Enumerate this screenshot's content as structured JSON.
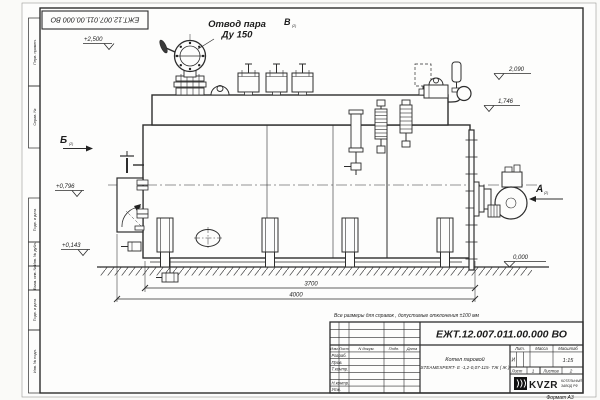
{
  "title_block": {
    "doc_number": "ЕЖТ.12.007.011.00.000  ВО",
    "doc_number_top": "ЕЖТ.12.007.011.00.000  ВО",
    "note": "Все размеры для справок , допустимые отклонения  ±100  мм",
    "product_line1": "Котел паровой",
    "product_line2": "STEAMEXPERT- Е -1,2-0,07-115- ТЖ ( Ж )",
    "lit_header": "Лит.",
    "mass_header": "Масса",
    "scale_header": "Масштаб",
    "lit_value": "И",
    "scale_value": "1:15",
    "sheet_label": "Лист",
    "sheet_value": "1",
    "sheets_label": "Листов",
    "sheets_value": "2",
    "sign_header": [
      "Изм.",
      "Лист",
      "N докум.",
      "Подп.",
      "Дата"
    ],
    "roles": [
      "Разраб.",
      "Пров.",
      "Т.контр.",
      "Н.контр.",
      "Утв."
    ],
    "format": "Формат А3"
  },
  "logo": {
    "name": "KVZR",
    "caption1": "КОТЕЛЬНЫЙ",
    "caption2": "ЗАВОД РФ"
  },
  "frame": {
    "labels": [
      "Перв. примен.",
      "Справ. №",
      "Подп. и дата",
      "Инв. № дубл.",
      "Взам. инв. №",
      "Подп. и дата",
      "Инв. № подл."
    ]
  },
  "annotations": {
    "steam_outlet_line1": "Отвод пара",
    "steam_outlet_line2": "Ду 150",
    "view_a": "А",
    "view_b": "Б",
    "view_v": "В",
    "view_sheet_ref": "(2)"
  },
  "dimensions": {
    "elev_top": "+2,500",
    "elev_2090": "2,090",
    "elev_1746": "1,746",
    "elev_796": "+0,796",
    "elev_143": "+0,143",
    "elev_zero": "0,000",
    "length_body": "3700",
    "length_total": "4000"
  }
}
